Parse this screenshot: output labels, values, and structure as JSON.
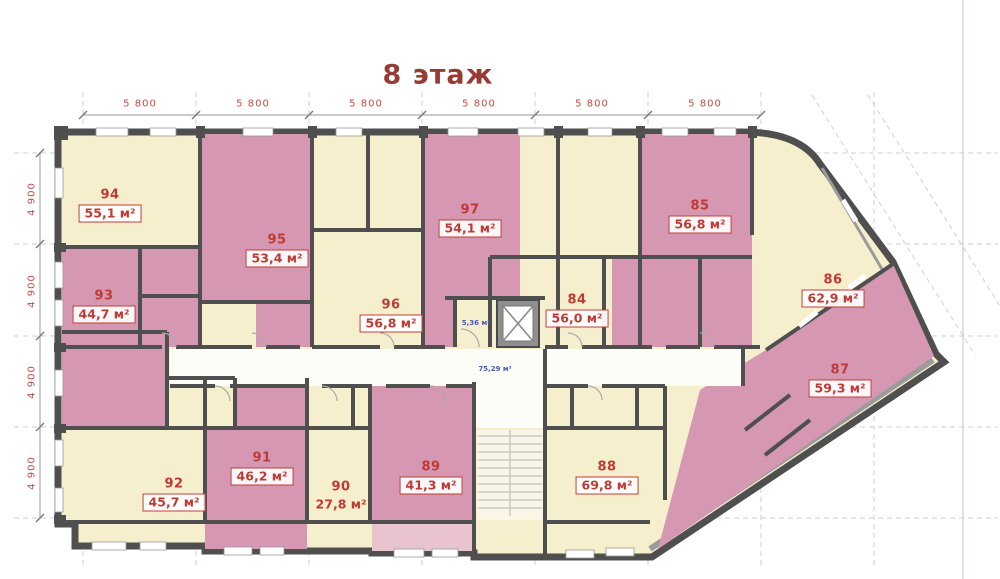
{
  "title": "8 этаж",
  "dimensions": {
    "top": [
      "5 800",
      "5 800",
      "5 800",
      "5 800",
      "5 800",
      "5 800"
    ],
    "left": [
      "4 900",
      "4 900",
      "4 900",
      "4 900"
    ]
  },
  "apartments": [
    {
      "number": "94",
      "area": "55,1 м²"
    },
    {
      "number": "95",
      "area": "53,4 м²"
    },
    {
      "number": "97",
      "area": "54,1 м²"
    },
    {
      "number": "85",
      "area": "56,8 м²"
    },
    {
      "number": "93",
      "area": "44,7 м²"
    },
    {
      "number": "96",
      "area": "56,8 м²"
    },
    {
      "number": "84",
      "area": "56,0 м²"
    },
    {
      "number": "86",
      "area": "62,9 м²"
    },
    {
      "number": "87",
      "area": "59,3 м²"
    },
    {
      "number": "92",
      "area": "45,7 м²"
    },
    {
      "number": "91",
      "area": "46,2 м²"
    },
    {
      "number": "90",
      "area": "27,8 м²"
    },
    {
      "number": "89",
      "area": "41,3 м²"
    },
    {
      "number": "88",
      "area": "69,8 м²"
    }
  ],
  "annotations": {
    "lobby_area": "5,36 м²",
    "corridor_area": "75,29 м²"
  },
  "colors": {
    "room_pink": "#d697b2",
    "room_cream": "#f6efcd",
    "balcony_pink": "#e9c4ce",
    "wall_dark": "#4f4f4f",
    "wall_gray": "#9b9b9b",
    "title_red": "#963c34",
    "dimension_red": "#c24b44",
    "label_red": "#bf3a34",
    "annotation_blue": "#4a5ab5"
  }
}
